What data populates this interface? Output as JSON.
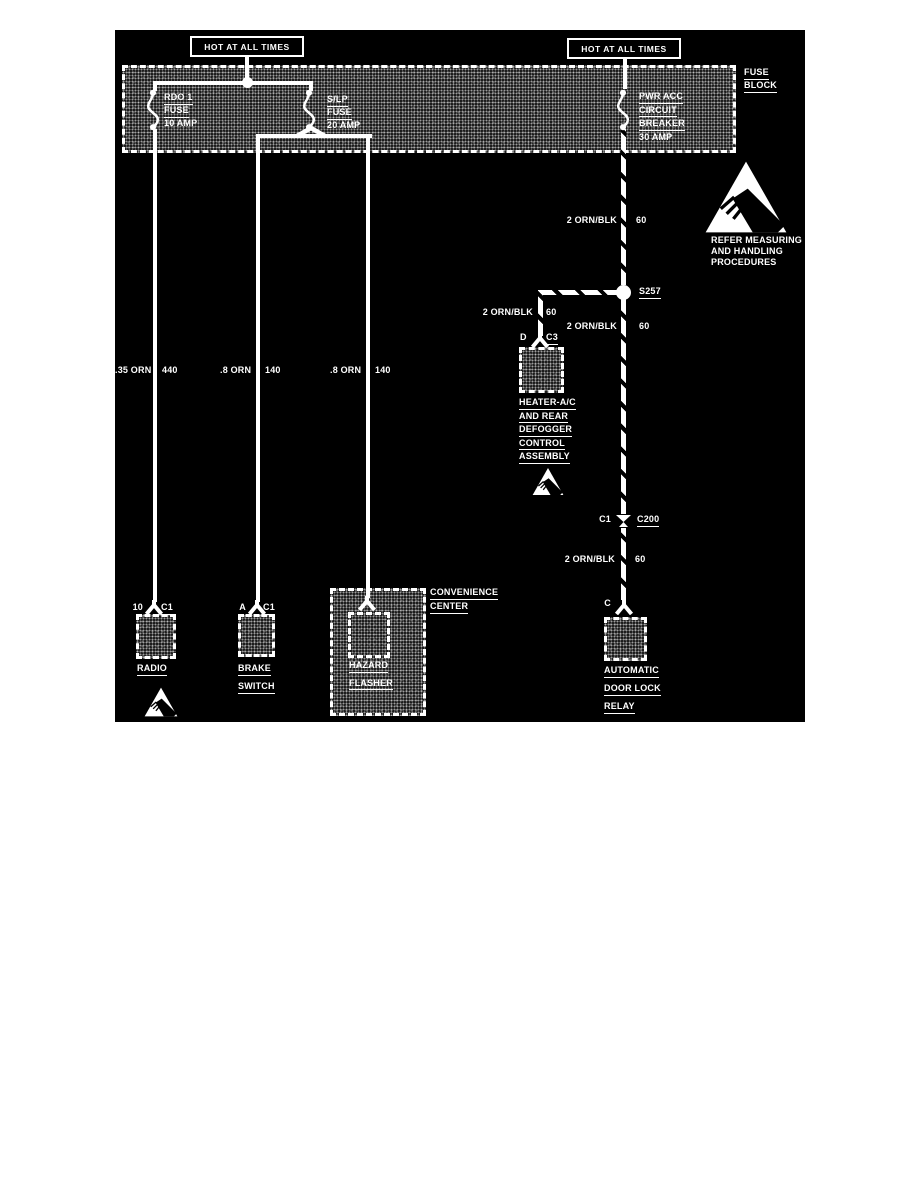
{
  "diagram": {
    "colors": {
      "background": "#000000",
      "foreground": "#ffffff"
    },
    "power_labels": {
      "left": "HOT AT ALL TIMES",
      "right": "HOT AT ALL TIMES"
    },
    "fuse_block": {
      "label_line1": "FUSE",
      "label_line2": "BLOCK",
      "rdo_fuse": {
        "line1": "RDO 1",
        "line2": "FUSE",
        "line3": "10 AMP"
      },
      "slp_fuse": {
        "line1": "S/LP",
        "line2": "FUSE",
        "line3": "20 AMP"
      },
      "pwr_acc_breaker": {
        "line1": "PWR ACC",
        "line2": "CIRCUIT",
        "line3": "BREAKER",
        "line4": "30 AMP"
      }
    },
    "wires": {
      "radio": {
        "size_color": ".35 ORN",
        "circuit": "440"
      },
      "brake": {
        "size_color": ".8 ORN",
        "circuit": "140"
      },
      "hazard": {
        "size_color": ".8 ORN",
        "circuit": "140"
      },
      "feed_upper": {
        "size_color": "2 ORN/BLK",
        "circuit": "60"
      },
      "heater_branch": {
        "size_color": "2 ORN/BLK",
        "circuit": "60"
      },
      "feed_mid": {
        "size_color": "2 ORN/BLK",
        "circuit": "60"
      },
      "feed_lower": {
        "size_color": "2 ORN/BLK",
        "circuit": "60"
      }
    },
    "splice_s257": "S257",
    "connector_c200": {
      "pin": "C1",
      "label": "C200"
    },
    "heater": {
      "pin": "D",
      "connector": "C3",
      "line1": "HEATER-A/C",
      "line2": "AND REAR",
      "line3": "DEFOGGER",
      "line4": "CONTROL",
      "line5": "ASSEMBLY"
    },
    "radio": {
      "pin": "10",
      "connector": "C1",
      "label": "RADIO"
    },
    "brake_switch": {
      "pin": "A",
      "connector": "C1",
      "line1": "BRAKE",
      "line2": "SWITCH"
    },
    "convenience_center": {
      "line1": "CONVENIENCE",
      "line2": "CENTER"
    },
    "hazard_flasher": {
      "line1": "HAZARD",
      "line2": "FLASHER"
    },
    "door_lock_relay": {
      "pin": "C",
      "line1": "AUTOMATIC",
      "line2": "DOOR LOCK",
      "line3": "RELAY"
    },
    "esd_note": {
      "line1": "REFER MEASURING",
      "line2": "AND HANDLING",
      "line3": "PROCEDURES"
    }
  }
}
